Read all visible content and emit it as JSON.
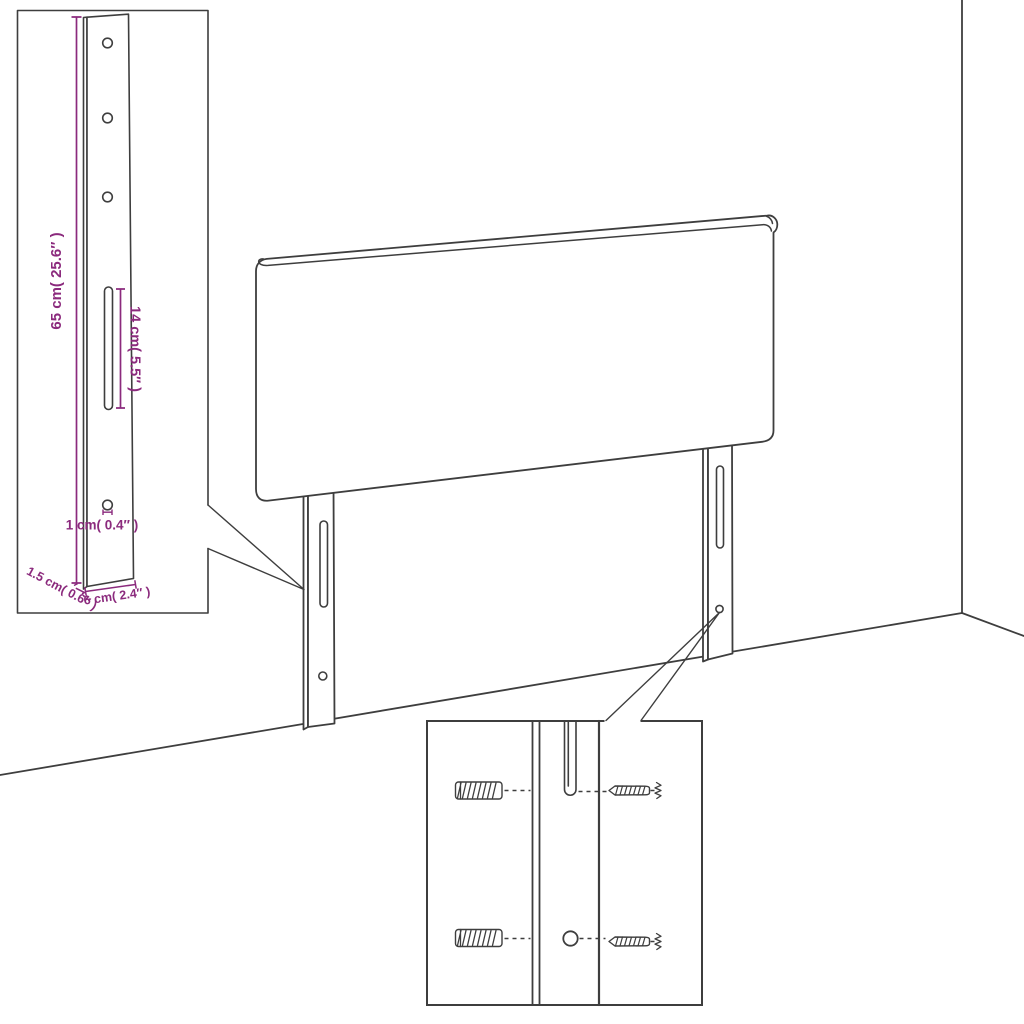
{
  "colors": {
    "line": "#3e3e3e",
    "dimension": "#8b2a7d",
    "background": "#ffffff"
  },
  "diagram": {
    "inset": {
      "height_label": "65 cm( 25.6″ )",
      "slot_label": "14 cm( 5.5″ )",
      "hole_label": "1 cm( 0.4″ )",
      "depth_label": "1.5 cm( 0.6″ )",
      "width_label": "6 cm( 2.4″ )"
    }
  }
}
